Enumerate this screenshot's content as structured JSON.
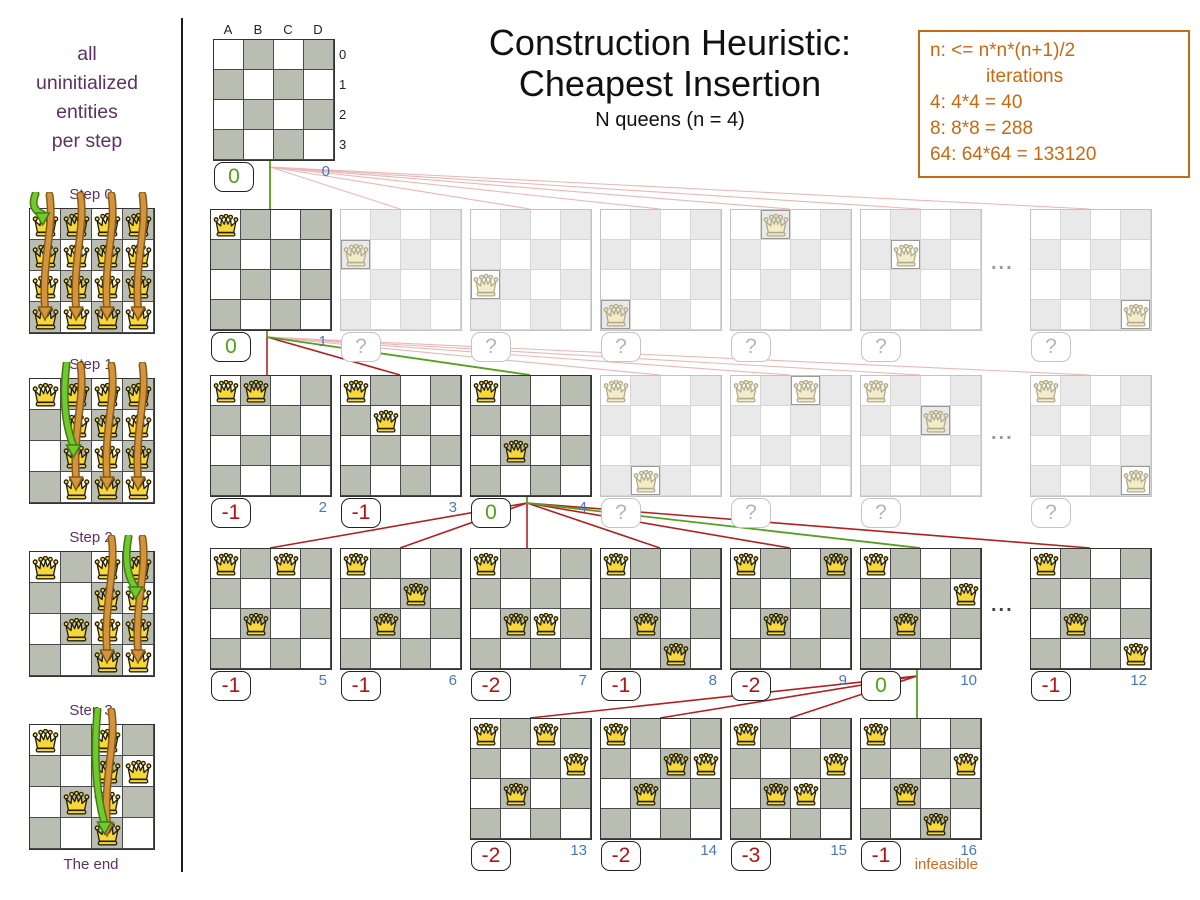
{
  "header": {
    "title_line1": "Construction Heuristic:",
    "title_line2": "Cheapest Insertion",
    "subtitle": "N queens (n = 4)"
  },
  "info_box": {
    "lines": [
      "n: <= n*n*(n+1)/2",
      "iterations",
      "4: 4*4 = 40",
      "8: 8*8 = 288",
      "64: 64*64 = 133120"
    ]
  },
  "sidebar": {
    "caption_lines": [
      "all",
      "uninitialized",
      "entities",
      "per step"
    ],
    "steps": [
      {
        "label": "Step 0",
        "fixed": [],
        "possible_cols": [
          0,
          1,
          2,
          3
        ],
        "green_target": {
          "col": 0,
          "row": 0
        }
      },
      {
        "label": "Step 1",
        "fixed": [
          [
            0,
            0
          ]
        ],
        "possible_cols": [
          1,
          2,
          3
        ],
        "green_target": {
          "col": 1,
          "row": 2
        }
      },
      {
        "label": "Step 2",
        "fixed": [
          [
            0,
            0
          ],
          [
            1,
            2
          ]
        ],
        "possible_cols": [
          2,
          3
        ],
        "green_target": {
          "col": 3,
          "row": 1
        }
      },
      {
        "label": "Step 3",
        "fixed": [
          [
            0,
            0
          ],
          [
            3,
            1
          ],
          [
            1,
            2
          ]
        ],
        "possible_cols": [
          2
        ],
        "green_target": {
          "col": 2,
          "row": 3
        }
      }
    ],
    "end_label": "The end"
  },
  "tree": {
    "board_labels": {
      "cols": [
        "A",
        "B",
        "C",
        "D"
      ],
      "rows": [
        "0",
        "1",
        "2",
        "3"
      ]
    },
    "nodes": [
      {
        "id": "root",
        "x": 213,
        "y": 39,
        "queens": [],
        "score": "0",
        "score_type": "best",
        "iter": "0",
        "faded": false,
        "labels": true
      },
      {
        "id": "b1",
        "x": 210,
        "y": 209,
        "queens": [
          [
            0,
            0
          ]
        ],
        "score": "0",
        "score_type": "best",
        "iter": "1",
        "faded": false
      },
      {
        "id": "b2",
        "x": 340,
        "y": 209,
        "queens": [
          [
            0,
            1
          ]
        ],
        "score": "?",
        "score_type": "unknown",
        "faded": true
      },
      {
        "id": "b3",
        "x": 470,
        "y": 209,
        "queens": [
          [
            0,
            2
          ]
        ],
        "score": "?",
        "score_type": "unknown",
        "faded": true
      },
      {
        "id": "b4",
        "x": 600,
        "y": 209,
        "queens": [
          [
            0,
            3
          ]
        ],
        "score": "?",
        "score_type": "unknown",
        "faded": true
      },
      {
        "id": "b5",
        "x": 730,
        "y": 209,
        "queens": [
          [
            1,
            0
          ]
        ],
        "score": "?",
        "score_type": "unknown",
        "faded": true
      },
      {
        "id": "b6",
        "x": 860,
        "y": 209,
        "queens": [
          [
            1,
            1
          ]
        ],
        "score": "?",
        "score_type": "unknown",
        "faded": true
      },
      {
        "id": "b7",
        "x": 1030,
        "y": 209,
        "queens": [
          [
            3,
            3
          ]
        ],
        "score": "?",
        "score_type": "unknown",
        "faded": true
      },
      {
        "id": "c1",
        "x": 210,
        "y": 375,
        "queens": [
          [
            0,
            0
          ],
          [
            1,
            0
          ]
        ],
        "score": "-1",
        "score_type": "bad",
        "iter": "2",
        "faded": false
      },
      {
        "id": "c2",
        "x": 340,
        "y": 375,
        "queens": [
          [
            0,
            0
          ],
          [
            1,
            1
          ]
        ],
        "score": "-1",
        "score_type": "bad",
        "iter": "3",
        "faded": false
      },
      {
        "id": "c3",
        "x": 470,
        "y": 375,
        "queens": [
          [
            0,
            0
          ],
          [
            1,
            2
          ]
        ],
        "score": "0",
        "score_type": "best",
        "iter": "4",
        "faded": false
      },
      {
        "id": "c4",
        "x": 600,
        "y": 375,
        "queens": [
          [
            0,
            0
          ],
          [
            1,
            3
          ]
        ],
        "score": "?",
        "score_type": "unknown",
        "faded": true
      },
      {
        "id": "c5",
        "x": 730,
        "y": 375,
        "queens": [
          [
            0,
            0
          ],
          [
            2,
            0
          ]
        ],
        "score": "?",
        "score_type": "unknown",
        "faded": true
      },
      {
        "id": "c6",
        "x": 860,
        "y": 375,
        "queens": [
          [
            0,
            0
          ],
          [
            2,
            1
          ]
        ],
        "score": "?",
        "score_type": "unknown",
        "faded": true
      },
      {
        "id": "c7",
        "x": 1030,
        "y": 375,
        "queens": [
          [
            0,
            0
          ],
          [
            3,
            3
          ]
        ],
        "score": "?",
        "score_type": "unknown",
        "faded": true
      },
      {
        "id": "d1",
        "x": 210,
        "y": 548,
        "queens": [
          [
            0,
            0
          ],
          [
            1,
            2
          ],
          [
            2,
            0
          ]
        ],
        "score": "-1",
        "score_type": "bad",
        "iter": "5",
        "faded": false
      },
      {
        "id": "d2",
        "x": 340,
        "y": 548,
        "queens": [
          [
            0,
            0
          ],
          [
            1,
            2
          ],
          [
            2,
            1
          ]
        ],
        "score": "-1",
        "score_type": "bad",
        "iter": "6",
        "faded": false
      },
      {
        "id": "d3",
        "x": 470,
        "y": 548,
        "queens": [
          [
            0,
            0
          ],
          [
            1,
            2
          ],
          [
            2,
            2
          ]
        ],
        "score": "-2",
        "score_type": "bad",
        "iter": "7",
        "faded": false
      },
      {
        "id": "d4",
        "x": 600,
        "y": 548,
        "queens": [
          [
            0,
            0
          ],
          [
            1,
            2
          ],
          [
            2,
            3
          ]
        ],
        "score": "-1",
        "score_type": "bad",
        "iter": "8",
        "faded": false
      },
      {
        "id": "d5",
        "x": 730,
        "y": 548,
        "queens": [
          [
            0,
            0
          ],
          [
            1,
            2
          ],
          [
            3,
            0
          ]
        ],
        "score": "-2",
        "score_type": "bad",
        "iter": "9",
        "faded": false
      },
      {
        "id": "d6",
        "x": 860,
        "y": 548,
        "queens": [
          [
            0,
            0
          ],
          [
            1,
            2
          ],
          [
            3,
            1
          ]
        ],
        "score": "0",
        "score_type": "best",
        "iter": "10",
        "faded": false
      },
      {
        "id": "d7",
        "x": 1030,
        "y": 548,
        "queens": [
          [
            0,
            0
          ],
          [
            1,
            2
          ],
          [
            3,
            3
          ]
        ],
        "score": "-1",
        "score_type": "bad",
        "iter": "12",
        "faded": false
      },
      {
        "id": "e1",
        "x": 470,
        "y": 718,
        "queens": [
          [
            0,
            0
          ],
          [
            1,
            2
          ],
          [
            3,
            1
          ],
          [
            2,
            0
          ]
        ],
        "score": "-2",
        "score_type": "bad",
        "iter": "13",
        "faded": false
      },
      {
        "id": "e2",
        "x": 600,
        "y": 718,
        "queens": [
          [
            0,
            0
          ],
          [
            1,
            2
          ],
          [
            3,
            1
          ],
          [
            2,
            1
          ]
        ],
        "score": "-2",
        "score_type": "bad",
        "iter": "14",
        "faded": false
      },
      {
        "id": "e3",
        "x": 730,
        "y": 718,
        "queens": [
          [
            0,
            0
          ],
          [
            1,
            2
          ],
          [
            3,
            1
          ],
          [
            2,
            2
          ]
        ],
        "score": "-3",
        "score_type": "bad",
        "iter": "15",
        "faded": false
      },
      {
        "id": "e4",
        "x": 860,
        "y": 718,
        "queens": [
          [
            0,
            0
          ],
          [
            1,
            2
          ],
          [
            3,
            1
          ],
          [
            2,
            3
          ]
        ],
        "score": "-1",
        "score_type": "bad",
        "iter": "16",
        "faded": false
      }
    ],
    "links": [
      {
        "from": "root",
        "to": "b1",
        "type": "chosen"
      },
      {
        "from": "root",
        "to": "b2",
        "type": "potential"
      },
      {
        "from": "root",
        "to": "b3",
        "type": "potential"
      },
      {
        "from": "root",
        "to": "b4",
        "type": "potential"
      },
      {
        "from": "root",
        "to": "b5",
        "type": "potential"
      },
      {
        "from": "root",
        "to": "b6",
        "type": "potential"
      },
      {
        "from": "root",
        "to": "b7",
        "type": "potential"
      },
      {
        "from": "b1",
        "to": "c1",
        "type": "evaluated"
      },
      {
        "from": "b1",
        "to": "c2",
        "type": "evaluated"
      },
      {
        "from": "b1",
        "to": "c3",
        "type": "chosen"
      },
      {
        "from": "b1",
        "to": "c4",
        "type": "potential"
      },
      {
        "from": "b1",
        "to": "c5",
        "type": "potential"
      },
      {
        "from": "b1",
        "to": "c6",
        "type": "potential"
      },
      {
        "from": "b1",
        "to": "c7",
        "type": "potential"
      },
      {
        "from": "c3",
        "to": "d1",
        "type": "evaluated"
      },
      {
        "from": "c3",
        "to": "d2",
        "type": "evaluated"
      },
      {
        "from": "c3",
        "to": "d3",
        "type": "evaluated"
      },
      {
        "from": "c3",
        "to": "d4",
        "type": "evaluated"
      },
      {
        "from": "c3",
        "to": "d5",
        "type": "evaluated"
      },
      {
        "from": "c3",
        "to": "d6",
        "type": "chosen"
      },
      {
        "from": "c3",
        "to": "d7",
        "type": "evaluated"
      },
      {
        "from": "d6",
        "to": "e1",
        "type": "evaluated"
      },
      {
        "from": "d6",
        "to": "e2",
        "type": "evaluated"
      },
      {
        "from": "d6",
        "to": "e3",
        "type": "evaluated"
      },
      {
        "from": "d6",
        "to": "e4",
        "type": "chosen"
      }
    ],
    "ellipsis": "...",
    "ellipses": [
      {
        "x": 991,
        "y": 252,
        "tone": "light"
      },
      {
        "x": 991,
        "y": 422,
        "tone": "light"
      },
      {
        "x": 991,
        "y": 594,
        "tone": "dark"
      }
    ],
    "infeasible_label": "infeasible"
  },
  "colors": {
    "chosen_green": "#55a020",
    "evaluated_red": "#b32020",
    "potential_pink": "#eab7b7",
    "score_green": "#4ea313",
    "score_red": "#b31212",
    "iteration_blue": "#4a79b8",
    "info_orange": "#c66a11",
    "sidebar_purple": "#5e3163",
    "board_dark_cell": "#b9bdb2",
    "queen_gold": "#f6d83d",
    "queen_outline": "#241f00",
    "queen_faded_fill": "#f2eccb",
    "queen_faded_outline": "#b3ab89",
    "arrow_orange": "#d2953e",
    "arrow_orange_dark": "#8a5a14",
    "arrow_green": "#72c82e",
    "arrow_green_dark": "#3f7d12"
  }
}
